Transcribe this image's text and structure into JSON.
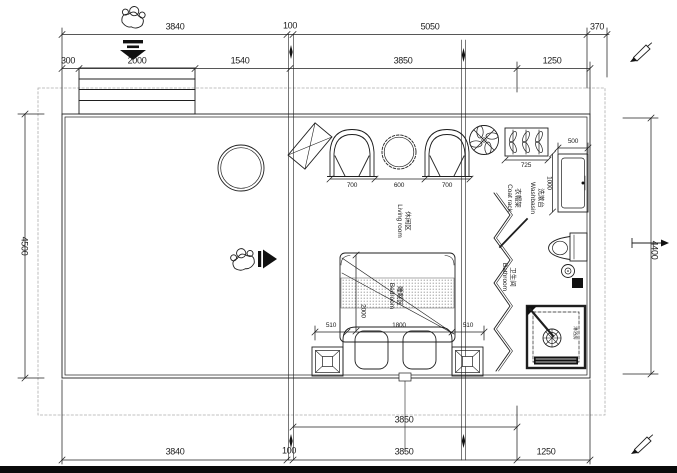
{
  "colors": {
    "line": "#1f1f1f",
    "dashed_boundary": "#adadad",
    "solid_fill": "#111111",
    "background": "#ffffff",
    "bottom_bar": "#0a0a0a"
  },
  "dims": {
    "top1": [
      "3840",
      "100",
      "5050",
      "370"
    ],
    "top2": [
      "300",
      "2000",
      "1540",
      "3850",
      "1250"
    ],
    "left_height": "4500",
    "right_height": "4400",
    "bottom1": [
      "3850"
    ],
    "bottom2": [
      "3840",
      "100",
      "3850",
      "1250"
    ],
    "living": [
      "700",
      "600",
      "700"
    ],
    "coat_rack_width": "725",
    "washbasin_width": "500",
    "washbasin_depth": "1000",
    "bed_side_left": "510",
    "bed_width": "1800",
    "bed_side_right": "510",
    "bed_length": "2000"
  },
  "rooms": {
    "living": {
      "zh": "休闲区",
      "en": "Living room"
    },
    "bedroom": {
      "zh": "睡眠区",
      "en": "Bedroom"
    },
    "bathroom": {
      "zh": "卫生间",
      "en": "Bathroom"
    },
    "washbasin": {
      "zh": "洗漱台",
      "en": "Washbasin"
    },
    "coat_rack": {
      "zh": "衣帽架",
      "en": "Coat rack"
    },
    "shower": {
      "zh": "淋浴房",
      "en": ""
    }
  },
  "icons": {
    "person_entering": "top-view walking person",
    "entry_arrow_down": "solid down arrow with bars",
    "person_inside": "top-view seated person",
    "walk_arrow_right": "solid right arrow with bar",
    "ceiling_fan": "circular fan with blades",
    "marker_pen_top_right": "diagonal pen marker",
    "marker_pen_bottom_right": "diagonal pen marker",
    "direction_arrow_right": "right arrow marker"
  }
}
